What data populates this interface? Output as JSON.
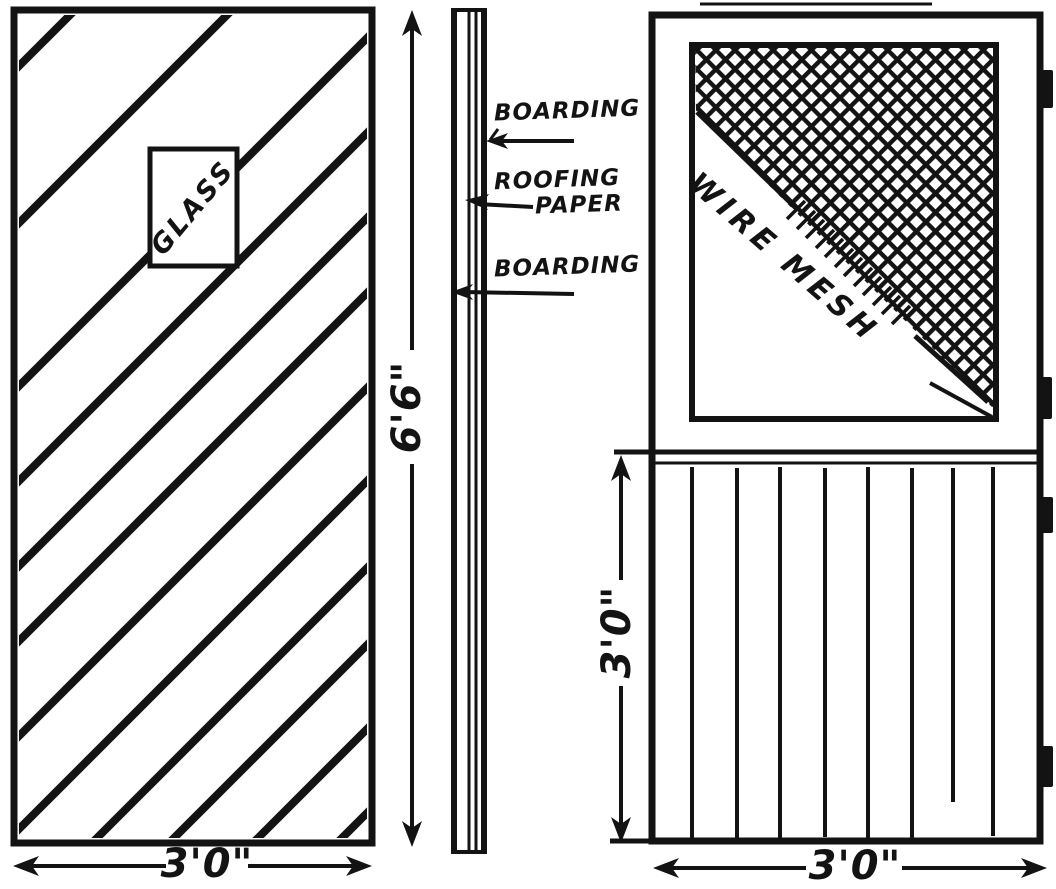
{
  "drawing": {
    "left_door": {
      "glass_label": "GLASS",
      "width_dim": "3'0\"",
      "height_dim": "6'6\""
    },
    "section": {
      "boarding_top": "BOARDING",
      "roofing_line1": "ROOFING",
      "roofing_line2": "PAPER",
      "boarding_bottom": "BOARDING"
    },
    "right_door": {
      "mesh_label": "WIRE MESH",
      "lower_height_dim": "3'0\"",
      "width_dim": "3'0\""
    },
    "colors": {
      "ink": "#131313",
      "paper": "#ffffff"
    }
  }
}
